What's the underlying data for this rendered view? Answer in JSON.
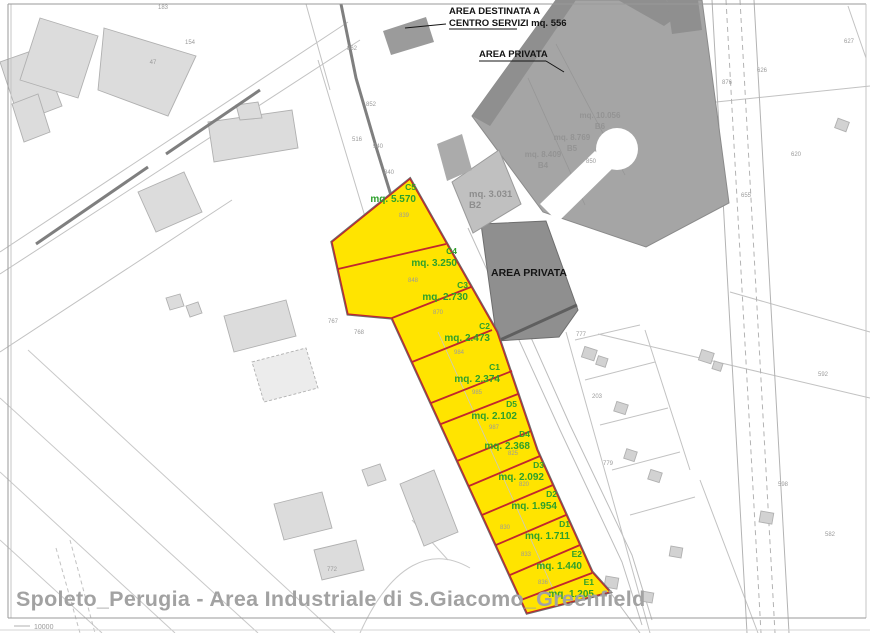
{
  "title": "Spoleto_Perugia - Area Industriale di S.Giacomo_Greenfield",
  "annotations": {
    "top_note_line1": "AREA DESTINATA A",
    "top_note_line2": "CENTRO SERVIZI mq. 556",
    "area_privata_top": "AREA PRIVATA",
    "area_privata_mid": "AREA PRIVATA",
    "scale_note": "10000"
  },
  "colors": {
    "lot_yellow": "#ffe400",
    "lot_divider_red": "#c1272d",
    "lot_label_green": "#2da02c",
    "private_gray": "#a5a5a5",
    "private_dark_gray": "#8f8f8f",
    "building_gray": "#dcdcdc",
    "title_gray": "#a2a2a2"
  },
  "lots": [
    {
      "id": "C5",
      "area": "mq. 5.570",
      "x": 416,
      "y": 190
    },
    {
      "id": "C4",
      "area": "mq. 3.250",
      "x": 457,
      "y": 254
    },
    {
      "id": "C3",
      "area": "mq. 2.730",
      "x": 468,
      "y": 288
    },
    {
      "id": "C2",
      "area": "mq. 2.473",
      "x": 490,
      "y": 329
    },
    {
      "id": "C1",
      "area": "mq. 2.374",
      "x": 500,
      "y": 370
    },
    {
      "id": "D5",
      "area": "mq. 2.102",
      "x": 517,
      "y": 407
    },
    {
      "id": "D4",
      "area": "mq. 2.368",
      "x": 530,
      "y": 437
    },
    {
      "id": "D3",
      "area": "mq. 2.092",
      "x": 544,
      "y": 468
    },
    {
      "id": "D2",
      "area": "mq. 1.954",
      "x": 557,
      "y": 497
    },
    {
      "id": "D1",
      "area": "mq. 1.711",
      "x": 570,
      "y": 527
    },
    {
      "id": "E2",
      "area": "mq. 1.440",
      "x": 582,
      "y": 557
    },
    {
      "id": "E1",
      "area": "mq. 1.205",
      "x": 594,
      "y": 585
    }
  ],
  "gray_lots": [
    {
      "id": "B2",
      "area": "mq. 3.031",
      "x": 469,
      "y": 197,
      "anchor": "start",
      "faint": false
    },
    {
      "id": "B6",
      "area": "mq. 10.056",
      "x": 600,
      "y": 118,
      "anchor": "middle",
      "faint": true
    },
    {
      "id": "B5",
      "area": "mq. 8.769",
      "x": 572,
      "y": 140,
      "anchor": "middle",
      "faint": true
    },
    {
      "id": "B4",
      "area": "mq. 8.409",
      "x": 543,
      "y": 157,
      "anchor": "middle",
      "faint": true
    }
  ],
  "parcel_numbers": [
    {
      "t": "839",
      "x": 404,
      "y": 217
    },
    {
      "t": "848",
      "x": 413,
      "y": 282
    },
    {
      "t": "870",
      "x": 438,
      "y": 314
    },
    {
      "t": "984",
      "x": 459,
      "y": 354
    },
    {
      "t": "985",
      "x": 477,
      "y": 394
    },
    {
      "t": "987",
      "x": 494,
      "y": 429
    },
    {
      "t": "825",
      "x": 513,
      "y": 455
    },
    {
      "t": "820",
      "x": 524,
      "y": 486
    },
    {
      "t": "830",
      "x": 505,
      "y": 529
    },
    {
      "t": "833",
      "x": 526,
      "y": 556
    },
    {
      "t": "836",
      "x": 543,
      "y": 584
    },
    {
      "t": "183",
      "x": 163,
      "y": 9
    },
    {
      "t": "154",
      "x": 190,
      "y": 44
    },
    {
      "t": "47",
      "x": 153,
      "y": 64
    },
    {
      "t": "862",
      "x": 352,
      "y": 50
    },
    {
      "t": "852",
      "x": 371,
      "y": 106
    },
    {
      "t": "516",
      "x": 357,
      "y": 141
    },
    {
      "t": "940",
      "x": 378,
      "y": 148
    },
    {
      "t": "840",
      "x": 389,
      "y": 174
    },
    {
      "t": "767",
      "x": 333,
      "y": 323
    },
    {
      "t": "768",
      "x": 359,
      "y": 334
    },
    {
      "t": "772",
      "x": 332,
      "y": 571
    },
    {
      "t": "876",
      "x": 727,
      "y": 84
    },
    {
      "t": "626",
      "x": 762,
      "y": 72
    },
    {
      "t": "627",
      "x": 849,
      "y": 43
    },
    {
      "t": "655",
      "x": 746,
      "y": 197
    },
    {
      "t": "620",
      "x": 796,
      "y": 156
    },
    {
      "t": "777",
      "x": 581,
      "y": 336
    },
    {
      "t": "203",
      "x": 597,
      "y": 398
    },
    {
      "t": "779",
      "x": 608,
      "y": 465
    },
    {
      "t": "592",
      "x": 823,
      "y": 376
    },
    {
      "t": "598",
      "x": 783,
      "y": 486
    },
    {
      "t": "582",
      "x": 830,
      "y": 536
    },
    {
      "t": "850",
      "x": 591,
      "y": 163
    }
  ]
}
